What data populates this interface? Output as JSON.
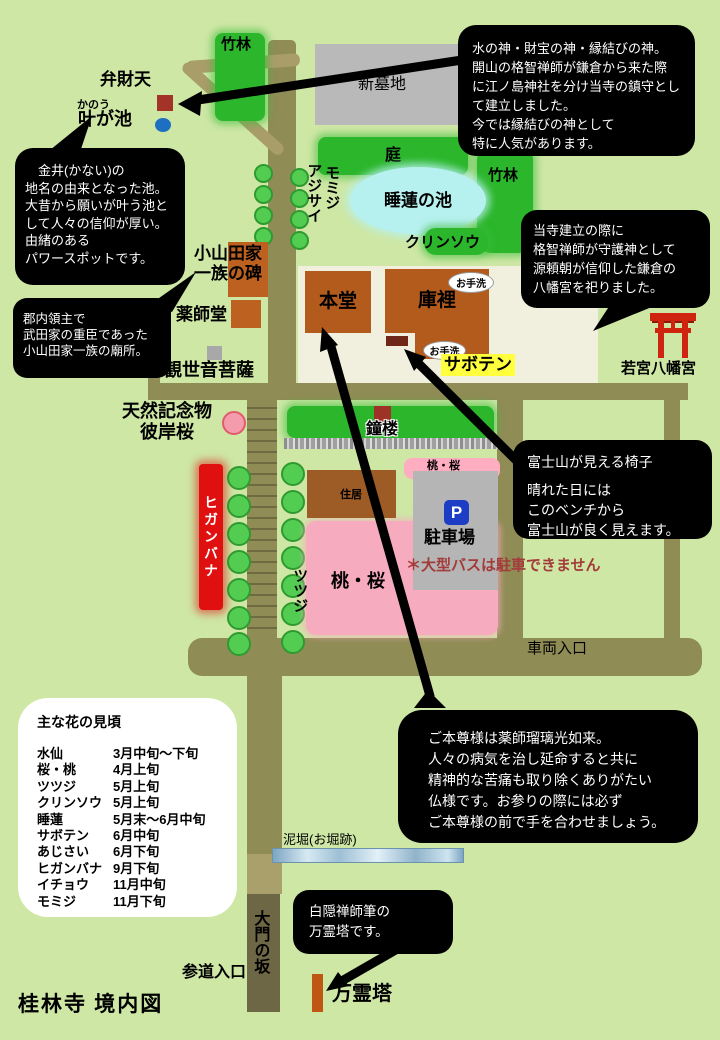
{
  "map_title": "桂林寺 境内図",
  "areas": {
    "chikurin_top": "竹林",
    "chikurin_right": "竹林",
    "shinbochi": "新墓地",
    "niwa": "庭",
    "suiren_no_ike": "睡蓮の池",
    "kurinso": "クリンソウ",
    "momiji": "モミジ",
    "ajisai": "アジサイ",
    "momo_sakura_small": "桃・桜",
    "momo_sakura_large": "桃・桜",
    "jukyo": "住居",
    "higanbana": "ヒガンバナ",
    "tsutsuji": "ツツジ",
    "shoro": "鐘楼",
    "parking_label": "駐車場",
    "parking_symbol": "P",
    "bus_note": "＊大型バスは駐車できません"
  },
  "landmarks": {
    "benzaiten": "弁財天",
    "kanou": "かのう",
    "kanagaike": "叶が池",
    "oyamada_hi": "小山田家\n一族の碑",
    "yakushido": "薬師堂",
    "kanzeon": "観世音菩薩",
    "hondo": "本堂",
    "kuri": "庫裡",
    "otearai": "お手洗",
    "saboten": "サボテン",
    "wakamiya": "若宮八幡宮",
    "tennen_kinenbutsu": "天然記念物\n彼岸桜",
    "sharyo_iriguchi": "車両入口",
    "dorobori": "泥堀(お堀跡)",
    "sando_iriguchi": "参道入口",
    "daimon_no_saka": "大門の坂",
    "banreito": "万霊塔"
  },
  "bubbles": {
    "benzaiten_note": "水の神・財宝の神・縁結びの神。\n開山の格智禅師が鎌倉から来た際\nに江ノ島神社を分け当寺の鎮守とし\nて建立しました。\n今では縁結びの神として\n特に人気があります。",
    "kanagaike_note": "　金井(かない)の\n地名の由来となった池。\n大昔から願いが叶う池と\nして人々の信仰が厚い。\n由緒のある\nパワースポットです。",
    "oyamada_note": "郡内領主で\n武田家の重臣であった\n小山田家一族の廟所。",
    "hachimangu_note": "当寺建立の際に\n格智禅師が守護神として\n源頼朝が信仰した鎌倉の\n八幡宮を祀りました。",
    "fuji_bench_title": "富士山が見える椅子",
    "fuji_bench_body": "晴れた日には\nこのベンチから\n富士山が良く見えます。",
    "honzon_note": "ご本尊様は薬師瑠璃光如来。\n人々の病気を治し延命すると共に\n精神的な苦痛も取り除くありがたい\n仏様です。お参りの際には必ず\nご本尊様の前で手を合わせましょう。",
    "hakuin_note": "白隠禅師筆の\n万霊塔です。"
  },
  "legend": {
    "title": "主な花の見頃",
    "rows": [
      {
        "name": "水仙",
        "period": "3月中旬〜下旬"
      },
      {
        "name": "桜・桃",
        "period": "4月上旬"
      },
      {
        "name": "ツツジ",
        "period": "5月上旬"
      },
      {
        "name": "クリンソウ",
        "period": "5月上旬"
      },
      {
        "name": "睡蓮",
        "period": "5月末〜6月中旬"
      },
      {
        "name": "サボテン",
        "period": "6月中旬"
      },
      {
        "name": "あじさい",
        "period": "6月下旬"
      },
      {
        "name": "ヒガンバナ",
        "period": "9月下旬"
      },
      {
        "name": "イチョウ",
        "period": "11月中旬"
      },
      {
        "name": "モミジ",
        "period": "11月下旬"
      }
    ]
  },
  "colors": {
    "background": "#cee7a5",
    "path_olive": "#8f8c55",
    "path_tan": "#a99d6a",
    "path_dark": "#6e6746",
    "vegetation_green": "#2bb62b",
    "building_brown": "#b35a1d",
    "monument_orange": "#bc6120",
    "pond_blue": "#b7f1ef",
    "sakura_pink": "#f7abbe",
    "higanbana_red": "#e01010",
    "parking_gray": "#b5b5b5",
    "cemetery_gray": "#b9b9b9",
    "torii_red": "#cf2510",
    "highlight_yellow": "#ffff3d",
    "warning_red": "#a33b3b",
    "precinct_cream": "#f1efdd"
  }
}
